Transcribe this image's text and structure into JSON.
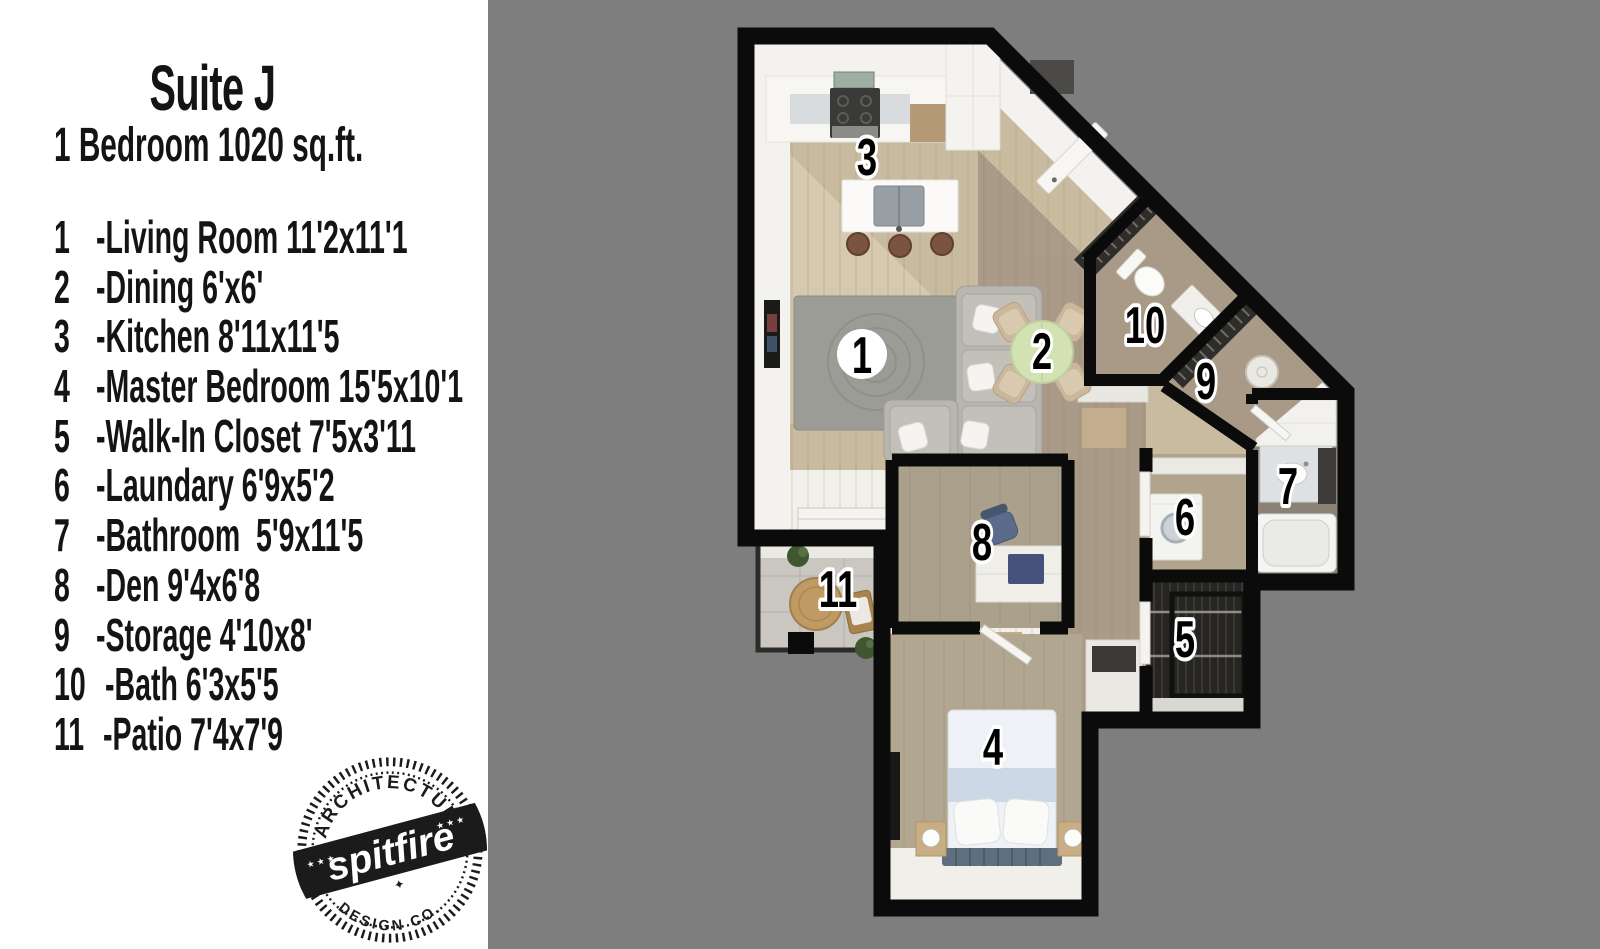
{
  "colors": {
    "canvas_bg": "#7e7e7e",
    "panel_bg": "#ffffff",
    "wall": "#0b0b0b",
    "floor_beige": "#c9bb9f",
    "floor_taupe": "#a99b87",
    "dining_table_green": "#d2e2b2",
    "text": "#141414"
  },
  "panel": {
    "title": "Suite J",
    "subtitle": "1 Bedroom 1020 sq.ft.",
    "legend": [
      {
        "num": "1",
        "label": "-Living Room 11'2x11'1"
      },
      {
        "num": "2",
        "label": "-Dining 6'x6'"
      },
      {
        "num": "3",
        "label": "-Kitchen 8'11x11'5"
      },
      {
        "num": "4",
        "label": "-Master Bedroom 15'5x10'1"
      },
      {
        "num": "5",
        "label": "-Walk-In Closet 7'5x3'11"
      },
      {
        "num": "6",
        "label": "-Laundary 6'9x5'2"
      },
      {
        "num": "7",
        "label": "-Bathroom  5'9x11'5"
      },
      {
        "num": "8",
        "label": "-Den 9'4x6'8"
      },
      {
        "num": "9",
        "label": "-Storage 4'10x8'"
      },
      {
        "num": "10",
        "label": "-Bath 6'3x5'5"
      },
      {
        "num": "11",
        "label": "-Patio 7'4x7'9"
      }
    ],
    "logo": {
      "arc_top": "ARCHITECTURE",
      "name": "spitfire",
      "arc_bottom": "DESIGN CO."
    }
  },
  "plan": {
    "room_labels": [
      {
        "num": "1",
        "x": 862,
        "y": 356,
        "badge": "circle"
      },
      {
        "num": "2",
        "x": 1042,
        "y": 352
      },
      {
        "num": "3",
        "x": 867,
        "y": 158
      },
      {
        "num": "4",
        "x": 993,
        "y": 748
      },
      {
        "num": "5",
        "x": 1185,
        "y": 640
      },
      {
        "num": "6",
        "x": 1185,
        "y": 518
      },
      {
        "num": "7",
        "x": 1288,
        "y": 487
      },
      {
        "num": "8",
        "x": 982,
        "y": 543
      },
      {
        "num": "9",
        "x": 1206,
        "y": 382
      },
      {
        "num": "10",
        "x": 1145,
        "y": 326
      },
      {
        "num": "11",
        "x": 838,
        "y": 590
      }
    ]
  }
}
